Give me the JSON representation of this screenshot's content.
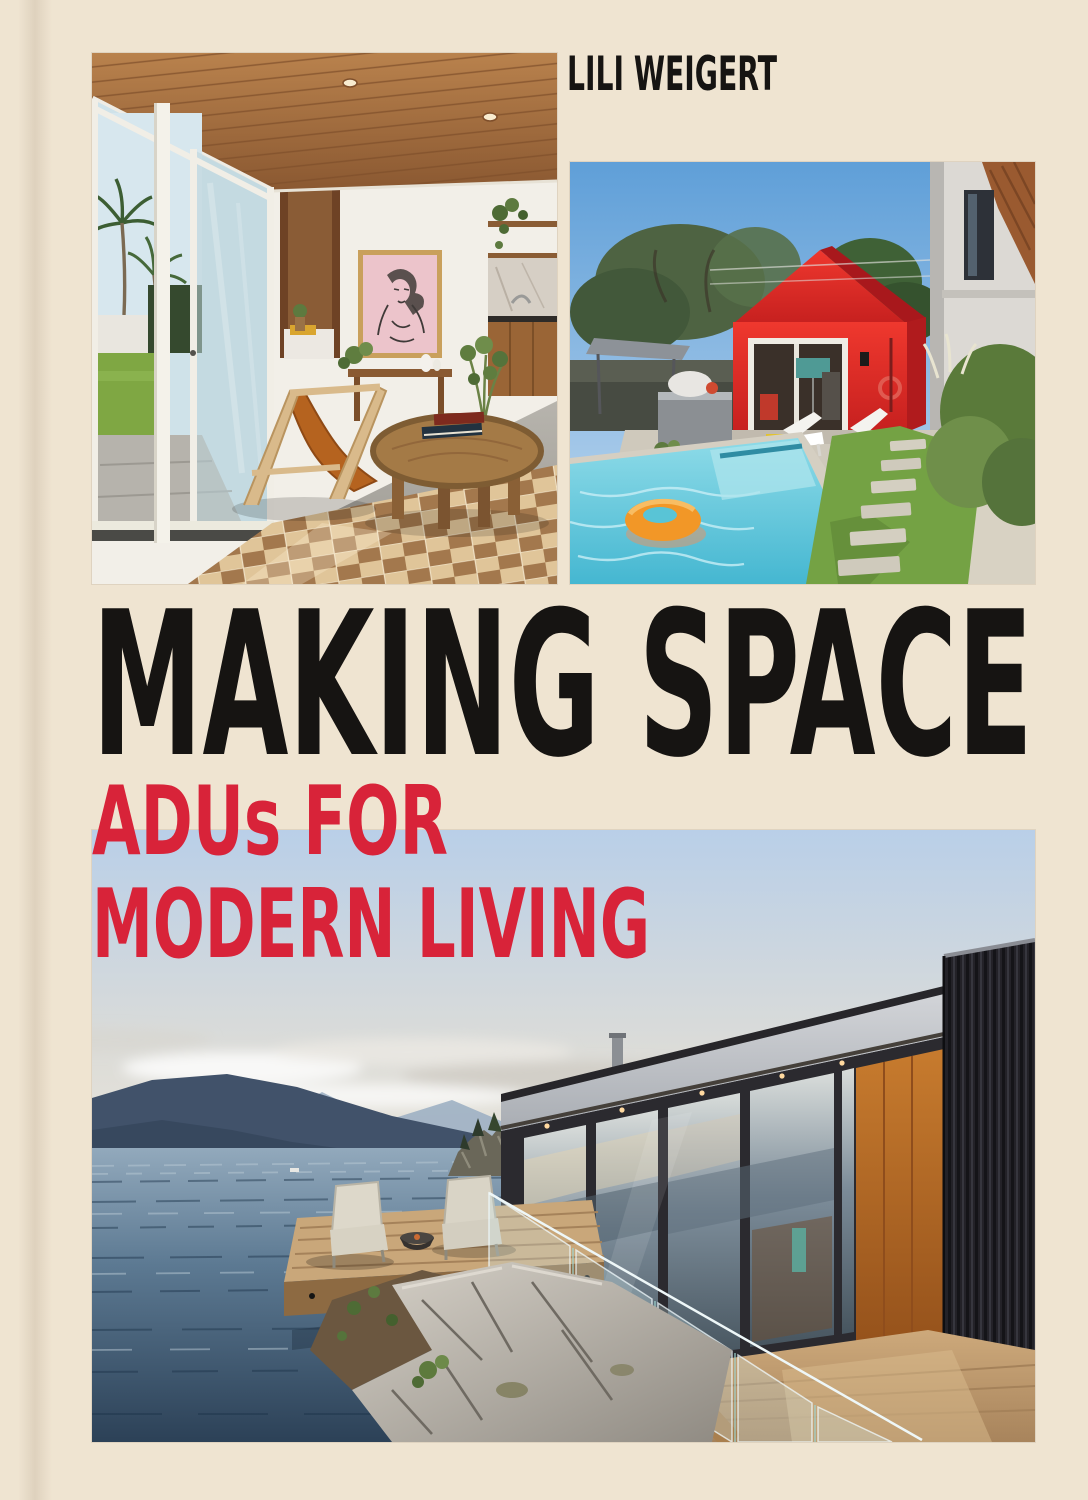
{
  "cover": {
    "author": "LILI WEIGERT",
    "title": "MAKING SPACE",
    "subtitle_line1": "ADUs FOR",
    "subtitle_line2": "MODERN LIVING",
    "colors": {
      "background_cream": "#efe4d1",
      "title_black": "#161412",
      "accent_red": "#d82339"
    }
  },
  "photos": {
    "top_left": {
      "name": "interior-living-room",
      "description": "Mid-century interior with wood plank ceiling, glass sliding doors opening to palms and lawn, pink portrait artwork over a wood console, kitchenette shelves, leather sling chair and round wooden coffee table on a checkerboard rug"
    },
    "top_right": {
      "name": "backyard-red-adu",
      "description": "Backyard with swimming pool and orange ring float, bright red gabled ADU with open glass doors, white loungers on a patio, grass with stepping stones beside a modern white house"
    },
    "bottom": {
      "name": "container-home-shoreline",
      "description": "Dark container-style home with glass walls and burnt-orange panel above a rocky ocean shore, cantilevered wooden deck with two chairs and a fire bowl, glass railing, mountains across the water at dusk"
    }
  }
}
